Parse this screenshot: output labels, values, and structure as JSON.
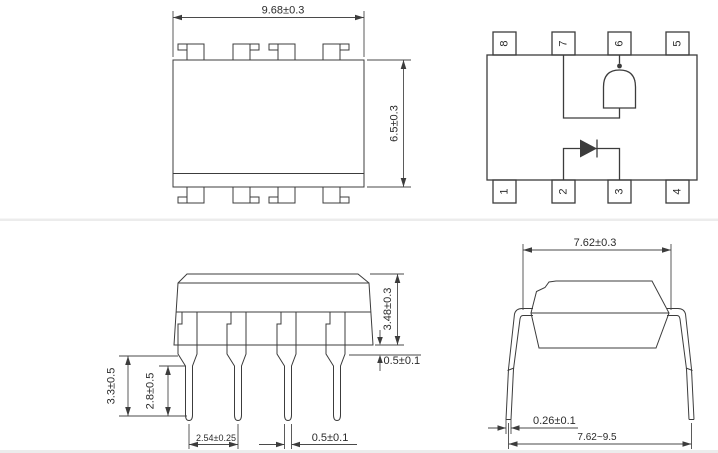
{
  "top_view": {
    "width_dim": "9.68±0.3",
    "height_dim": "6.5±0.3"
  },
  "schematic": {
    "pins_top": [
      "8",
      "7",
      "6",
      "5"
    ],
    "pins_bottom": [
      "1",
      "2",
      "3",
      "4"
    ]
  },
  "front_view": {
    "body_height_dim": "3.48±0.3",
    "standoff_dim": "0.5±0.1",
    "lead_length_dim": "3.3±0.5",
    "lead_inner_dim": "2.8±0.5",
    "lead_pitch_dim": "2.54±0.25",
    "lead_width_dim": "0.5±0.1"
  },
  "side_view": {
    "row_spacing_dim": "7.62±0.3",
    "lead_thickness_dim": "0.26±0.1",
    "lead_spread_dim": "7.62~9.5"
  },
  "colors": {
    "line": "#3c3c3c",
    "background": "#ffffff"
  }
}
